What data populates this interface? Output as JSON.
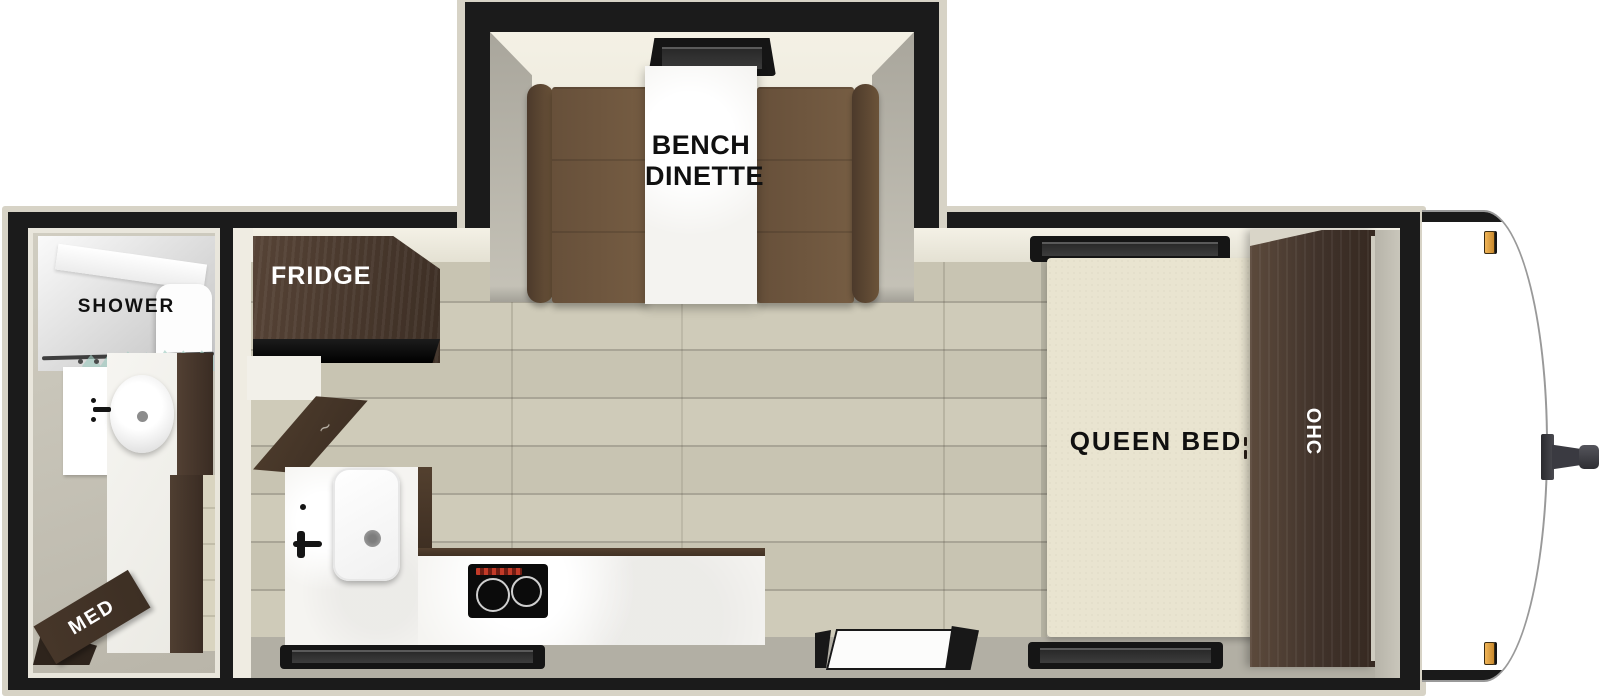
{
  "floorplan": {
    "slideout": {
      "label_line1": "BENCH",
      "label_line2": "DINETTE"
    },
    "kitchen": {
      "fridge_label": "FRIDGE"
    },
    "bathroom": {
      "shower_label": "SHOWER",
      "med_label": "MED"
    },
    "bedroom": {
      "bed_label": "QUEEN BED",
      "cabinet_label": "OHC"
    },
    "colors": {
      "wall": "#1b1b1b",
      "exterior_trim": "#d7d3c6",
      "wood_floor": "#cdc9b7",
      "bathroom_floor": "#c4c0b4",
      "walkway_gray": "#b2afa4",
      "cabinet_wood": "#46362a",
      "bench_upholstery": "#6e563e",
      "countertop": "#f5f4f1",
      "bed_mattress": "#e9e4d0",
      "marker_light": "#e2a145",
      "curtain_glass": "#a2ccc1"
    }
  }
}
